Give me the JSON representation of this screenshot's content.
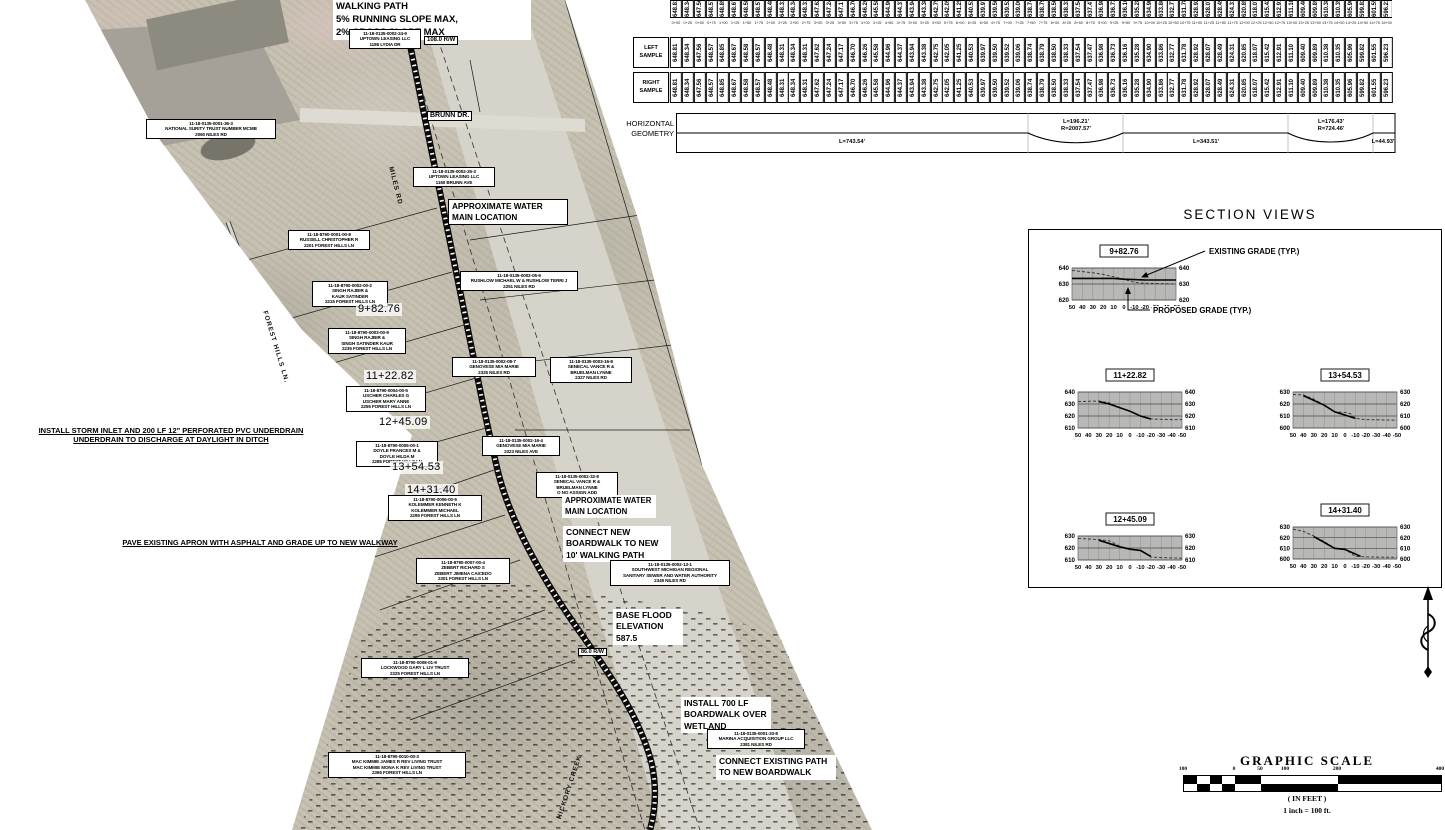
{
  "profile_table": {
    "left_label": [
      "LEFT",
      "SAMPLE"
    ],
    "right_label": [
      "RIGHT",
      "SAMPLE"
    ],
    "elevations": [
      "648.81",
      "648.34",
      "647.56",
      "648.57",
      "648.85",
      "648.67",
      "648.58",
      "648.57",
      "648.48",
      "648.31",
      "648.34",
      "648.31",
      "647.62",
      "647.24",
      "647.17",
      "646.70",
      "646.26",
      "645.58",
      "644.96",
      "644.37",
      "643.94",
      "643.38",
      "642.75",
      "642.05",
      "641.25",
      "640.53",
      "639.97",
      "639.50",
      "639.52",
      "639.06",
      "638.74",
      "638.79",
      "638.50",
      "638.33",
      "637.54",
      "637.47",
      "636.98",
      "636.73",
      "636.16",
      "635.28",
      "634.90",
      "633.86",
      "632.77",
      "631.78",
      "628.92",
      "628.07",
      "628.49",
      "624.31",
      "620.85",
      "618.07",
      "615.42",
      "612.91",
      "611.10",
      "609.40",
      "609.89",
      "610.38",
      "610.35",
      "605.96",
      "599.82",
      "601.55",
      "596.23"
    ],
    "stations": [
      "0+00",
      "0+25",
      "0+50",
      "0+75",
      "1+00",
      "1+25",
      "1+50",
      "1+75",
      "2+00",
      "2+25",
      "2+50",
      "2+75",
      "3+00",
      "3+25",
      "3+50",
      "3+75",
      "4+00",
      "4+25",
      "4+50",
      "4+75",
      "5+00",
      "5+25",
      "5+50",
      "5+75",
      "6+00",
      "6+25",
      "6+50",
      "6+75",
      "7+00",
      "7+25",
      "7+50",
      "7+75",
      "8+00",
      "8+25",
      "8+50",
      "8+75",
      "9+00",
      "9+25",
      "9+50",
      "9+75",
      "10+00",
      "10+25",
      "10+50",
      "10+75",
      "11+00",
      "11+25",
      "11+50",
      "11+75",
      "12+00",
      "12+25",
      "12+50",
      "12+75",
      "13+00",
      "13+25",
      "13+50",
      "13+75",
      "14+00",
      "14+25",
      "14+50",
      "14+75",
      "15+00"
    ]
  },
  "horizontal_geometry": {
    "label_line1": "HORIZONTAL",
    "label_line2": "GEOMETRY",
    "segments": [
      {
        "type": "tangent",
        "length": "L=743.54'"
      },
      {
        "type": "curve",
        "length": "L=196.21'",
        "radius": "R=2007.57'"
      },
      {
        "type": "tangent",
        "length": "L=343.51'"
      },
      {
        "type": "curve",
        "length": "L=176.43'",
        "radius": "R=724.46'"
      },
      {
        "type": "tangent",
        "length": "L=44.93'"
      }
    ]
  },
  "section_views": {
    "title": "SECTION VIEWS",
    "existing_grade_label": "EXISTING GRADE (TYP.)",
    "proposed_grade_label": "PROPOSED GRADE (TYP.)",
    "sections": [
      {
        "station": "9+82.76",
        "x": 1050,
        "y": 242,
        "ymax": 640,
        "ymin": 620,
        "plot_h": 32,
        "yticks": [
          "640",
          "630",
          "620"
        ],
        "xticks": [
          "50",
          "40",
          "30",
          "20",
          "10",
          "0",
          "-10",
          "-20",
          "-30",
          "-40",
          "-50"
        ],
        "existing": [
          [
            50,
            638.5
          ],
          [
            30,
            637
          ],
          [
            20,
            636
          ],
          [
            10,
            634.5
          ],
          [
            0,
            633
          ],
          [
            -10,
            631
          ],
          [
            -20,
            630.5
          ],
          [
            -50,
            630
          ]
        ],
        "proposed": [
          [
            50,
            633.5
          ],
          [
            10,
            633.5
          ],
          [
            0,
            633
          ],
          [
            -20,
            632.5
          ],
          [
            -50,
            632.5
          ]
        ]
      },
      {
        "station": "11+22.82",
        "x": 1056,
        "y": 366,
        "ymax": 640,
        "ymin": 610,
        "plot_h": 36,
        "yticks": [
          "640",
          "630",
          "620",
          "610"
        ],
        "xticks": [
          "50",
          "40",
          "30",
          "20",
          "10",
          "0",
          "-10",
          "-20",
          "-30",
          "-40",
          "-50"
        ],
        "existing": [
          [
            50,
            632
          ],
          [
            30,
            632.5
          ],
          [
            20,
            631
          ],
          [
            10,
            627
          ],
          [
            0,
            624
          ],
          [
            -10,
            620
          ],
          [
            -20,
            617.5
          ],
          [
            -40,
            617
          ],
          [
            -50,
            617
          ]
        ],
        "proposed": [
          [
            30,
            632
          ],
          [
            20,
            630
          ],
          [
            0,
            624
          ],
          [
            -10,
            620
          ],
          [
            -20,
            617.5
          ]
        ]
      },
      {
        "station": "13+54.53",
        "x": 1271,
        "y": 366,
        "ymax": 630,
        "ymin": 600,
        "plot_h": 36,
        "yticks": [
          "630",
          "620",
          "610",
          "600"
        ],
        "xticks": [
          "50",
          "40",
          "30",
          "20",
          "10",
          "0",
          "-10",
          "-20",
          "-30",
          "-40",
          "-50"
        ],
        "existing": [
          [
            50,
            628
          ],
          [
            40,
            627.5
          ],
          [
            30,
            624
          ],
          [
            20,
            619
          ],
          [
            10,
            613.5
          ],
          [
            0,
            613
          ],
          [
            -5,
            612
          ],
          [
            -10,
            608
          ],
          [
            -20,
            607
          ],
          [
            -50,
            606.5
          ]
        ],
        "proposed": [
          [
            40,
            627
          ],
          [
            20,
            619
          ],
          [
            10,
            613.5
          ],
          [
            -10,
            608
          ]
        ]
      },
      {
        "station": "12+45.09",
        "x": 1056,
        "y": 510,
        "ymax": 630,
        "ymin": 610,
        "plot_h": 24,
        "yticks": [
          "630",
          "620",
          "610"
        ],
        "xticks": [
          "50",
          "40",
          "30",
          "20",
          "10",
          "0",
          "-10",
          "-20",
          "-30",
          "-40",
          "-50"
        ],
        "existing": [
          [
            50,
            628
          ],
          [
            40,
            627.5
          ],
          [
            30,
            627
          ],
          [
            20,
            626
          ],
          [
            10,
            621.5
          ],
          [
            0,
            619
          ],
          [
            -10,
            618
          ],
          [
            -20,
            612.5
          ],
          [
            -30,
            612
          ],
          [
            -50,
            611.5
          ]
        ],
        "proposed": [
          [
            30,
            626.5
          ],
          [
            10,
            621
          ],
          [
            0,
            619
          ],
          [
            -10,
            618
          ],
          [
            -20,
            613
          ]
        ]
      },
      {
        "station": "14+31.40",
        "x": 1271,
        "y": 501,
        "ymax": 630,
        "ymin": 600,
        "plot_h": 32,
        "yticks": [
          "630",
          "620",
          "610",
          "600"
        ],
        "xticks": [
          "50",
          "40",
          "30",
          "20",
          "10",
          "0",
          "-10",
          "-20",
          "-30",
          "-40",
          "-50"
        ],
        "existing": [
          [
            50,
            628
          ],
          [
            40,
            626
          ],
          [
            30,
            621.5
          ],
          [
            20,
            616.5
          ],
          [
            10,
            610
          ],
          [
            0,
            609
          ],
          [
            -10,
            602.5
          ],
          [
            -20,
            602
          ],
          [
            -50,
            601.5
          ]
        ],
        "proposed": [
          [
            30,
            621
          ],
          [
            10,
            610
          ],
          [
            0,
            609
          ],
          [
            -15,
            602.5
          ]
        ]
      }
    ]
  },
  "graphic_scale": {
    "title": "GRAPHIC SCALE",
    "labels": [
      "100",
      "0",
      "50",
      "100",
      "200",
      "400"
    ],
    "units_note": "( IN FEET )",
    "ratio_note": "1 inch = 100 ft."
  },
  "map": {
    "labels": [
      {
        "name": "walking-path-note",
        "kind": "note",
        "x": 333,
        "y": 0,
        "w": 192,
        "fs": 9.5,
        "lines": [
          "WALKING PATH",
          "5% RUNNING SLOPE MAX,",
          "2% CROSS SLOPE MAX"
        ]
      },
      {
        "name": "parcel-uptown-lydia",
        "kind": "parcel",
        "x": 349,
        "y": 29,
        "w": 66,
        "fs": 4.6,
        "lines": [
          "11-18-0135-0002-24-9",
          "UPTOWN LEASING LLC",
          "1186 LYDIA DR"
        ]
      },
      {
        "name": "rw-108-label",
        "kind": "smallbox",
        "x": 424,
        "y": 36,
        "fs": 6,
        "lines": [
          "108.0 R/W"
        ]
      },
      {
        "name": "street-brunn-dr",
        "kind": "smallbox",
        "x": 427,
        "y": 111,
        "fs": 7,
        "lines": [
          "BRUNN DR."
        ]
      },
      {
        "name": "parcel-national-surity",
        "kind": "parcel",
        "x": 146,
        "y": 119,
        "w": 124,
        "fs": 4.6,
        "lines": [
          "11-18-0135-0001-36-3",
          "NATIONAL SURITY TRUST NUMBER MCMB",
          "2060 NILES RD"
        ]
      },
      {
        "name": "street-miles-rd",
        "kind": "street",
        "x": 394,
        "y": 166,
        "fs": 6.5,
        "rot": 76,
        "lines": [
          "MILES RD"
        ]
      },
      {
        "name": "parcel-uptown-brunn",
        "kind": "parcel",
        "x": 413,
        "y": 167,
        "w": 76,
        "fs": 4.6,
        "lines": [
          "11-18-0135-0002-25-3",
          "UPTOWN LEASING LLC",
          "1160 BRUNN AVE"
        ]
      },
      {
        "name": "water-main-note-1",
        "kind": "notebox",
        "x": 448,
        "y": 199,
        "w": 112,
        "fs": 8.2,
        "lines": [
          "APPROXIMATE WATER",
          "MAIN LOCATION"
        ]
      },
      {
        "name": "parcel-russell",
        "kind": "parcel",
        "x": 288,
        "y": 230,
        "w": 76,
        "fs": 4.6,
        "lines": [
          "11-18-8790-0001-00-8",
          "RUSSELL CHRISTOPHER R",
          "2201 FOREST HILLS LN"
        ]
      },
      {
        "name": "parcel-rushlow",
        "kind": "parcel",
        "x": 460,
        "y": 271,
        "w": 112,
        "fs": 4.6,
        "lines": [
          "11-18-0135-0002-05-9",
          "RUSHLOW MICHAEL W & RUSHLOW TERRI J",
          "2251 NILES RD"
        ]
      },
      {
        "name": "parcel-singh-kaur",
        "kind": "parcel",
        "x": 312,
        "y": 281,
        "w": 70,
        "fs": 4.6,
        "lines": [
          "11-18-8790-0002-00-2",
          "SINGH RAJBIR &",
          "KAUR SATINDER",
          "2215 FOREST HILLS LN"
        ]
      },
      {
        "name": "map-station-9-82",
        "kind": "station",
        "x": 356,
        "y": 303,
        "fs": 11,
        "lines": [
          "9+82.76"
        ]
      },
      {
        "name": "parcel-singh-satinder",
        "kind": "parcel",
        "x": 328,
        "y": 328,
        "w": 72,
        "fs": 4.6,
        "lines": [
          "11-18-8790-0003-00-9",
          "SINGH RAJBIR &",
          "SINGH SATINDER KAUR",
          "2235 FOREST HILLS LN"
        ]
      },
      {
        "name": "street-forest-hills-ln",
        "kind": "street",
        "x": 268,
        "y": 310,
        "fs": 6.5,
        "rot": 73,
        "lines": [
          "FOREST HILLS LN."
        ]
      },
      {
        "name": "parcel-genovese-2325",
        "kind": "parcel",
        "x": 452,
        "y": 357,
        "w": 78,
        "fs": 4.6,
        "lines": [
          "11-18-0135-0002-08-7",
          "GENOVESE MIA MARIE",
          "2325 NILES RD"
        ]
      },
      {
        "name": "parcel-senecal-2327",
        "kind": "parcel",
        "x": 550,
        "y": 357,
        "w": 76,
        "fs": 4.6,
        "lines": [
          "11-18-0135-0003-16-8",
          "SENECAL VANCE R &",
          "BRUELMAN LYNNE",
          "2327 NILES RD"
        ]
      },
      {
        "name": "map-station-11-22",
        "kind": "station",
        "x": 364,
        "y": 370,
        "fs": 11,
        "lines": [
          "11+22.82"
        ]
      },
      {
        "name": "parcel-uscher",
        "kind": "parcel",
        "x": 346,
        "y": 386,
        "w": 74,
        "fs": 4.6,
        "lines": [
          "11-18-8790-0004-00-5",
          "USCHER CHARLES G",
          "USCHER MARY ANNE",
          "2255 FOREST HILLS LN"
        ]
      },
      {
        "name": "map-station-12-45",
        "kind": "station",
        "x": 377,
        "y": 416,
        "fs": 11,
        "lines": [
          "12+45.09"
        ]
      },
      {
        "name": "storm-inlet-note",
        "kind": "underline",
        "x": 30,
        "y": 427,
        "w": 282,
        "fs": 7.5,
        "lines": [
          "INSTALL STORM INLET AND 200 LF 12\" PERFORATED PVC UNDERDRAIN",
          "UNDERDRAIN TO DISCHARGE AT DAYLIGHT IN DITCH"
        ]
      },
      {
        "name": "parcel-doyle",
        "kind": "parcel",
        "x": 356,
        "y": 441,
        "w": 76,
        "fs": 4.6,
        "lines": [
          "11-18-8790-0005-00-1",
          "DOYLE FRANCES M &",
          "DOYLE HILDA M",
          "2285 FOREST HILLS LN"
        ]
      },
      {
        "name": "parcel-genovese-2323",
        "kind": "parcel",
        "x": 482,
        "y": 436,
        "w": 72,
        "fs": 4.6,
        "lines": [
          "11-18-0135-0002-16-4",
          "GENOVESE MIA MARIE",
          "2323 NILES AVE"
        ]
      },
      {
        "name": "map-station-13-54",
        "kind": "station",
        "x": 390,
        "y": 461,
        "fs": 11,
        "lines": [
          "13+54.53"
        ]
      },
      {
        "name": "parcel-senecal-noadd",
        "kind": "parcel",
        "x": 536,
        "y": 472,
        "w": 76,
        "fs": 4.6,
        "lines": [
          "11-18-0135-0002-32-8",
          "SENECAL VANCE R &",
          "BRUELMAN LYNNE",
          "O NO ASSIGN ADD"
        ]
      },
      {
        "name": "map-station-14-31",
        "kind": "station",
        "x": 405,
        "y": 484,
        "fs": 11,
        "lines": [
          "14+31.40"
        ]
      },
      {
        "name": "parcel-kolemmer",
        "kind": "parcel",
        "x": 388,
        "y": 495,
        "w": 88,
        "fs": 4.6,
        "lines": [
          "11-18-8790-0006-00-5",
          "KOLEMMER KENNETH K",
          "KOLEMMER MICHAEL",
          "2295 FOREST HILLS LN"
        ]
      },
      {
        "name": "water-main-note-2",
        "kind": "note",
        "x": 562,
        "y": 495,
        "w": 88,
        "fs": 7.8,
        "lines": [
          "APPROXIMATE WATER",
          "MAIN LOCATION"
        ]
      },
      {
        "name": "pave-apron-note",
        "kind": "underline",
        "x": 100,
        "y": 539,
        "w": 320,
        "fs": 7.5,
        "lines": [
          "PAVE EXISTING APRON WITH ASPHALT AND GRADE UP TO NEW WALKWAY"
        ]
      },
      {
        "name": "connect-boardwalk-note",
        "kind": "note",
        "x": 563,
        "y": 526,
        "w": 102,
        "fs": 8.5,
        "lines": [
          "CONNECT NEW",
          "BOARDWALK TO NEW",
          "10' WALKING PATH"
        ]
      },
      {
        "name": "parcel-zebert",
        "kind": "parcel",
        "x": 416,
        "y": 558,
        "w": 88,
        "fs": 4.6,
        "lines": [
          "11-18-8790-0007-00-4",
          "ZEBERT RICHARD S",
          "ZEBERT JIMENA CAICEDO",
          "2301 FOREST HILLS LN"
        ]
      },
      {
        "name": "parcel-swmr-authority",
        "kind": "parcel",
        "x": 610,
        "y": 560,
        "w": 114,
        "fs": 4.6,
        "lines": [
          "11-18-0135-0002-13-1",
          "SOUTHWEST MICHIGAN REGIONAL",
          "SANITARY SEWER AND WATER AUTHORITY",
          "2349 NILES RD"
        ]
      },
      {
        "name": "base-flood-note",
        "kind": "note",
        "x": 613,
        "y": 609,
        "w": 64,
        "fs": 8.5,
        "lines": [
          "BASE FLOOD",
          "ELEVATION",
          "587.5"
        ]
      },
      {
        "name": "rw-86-label",
        "kind": "smallbox",
        "x": 578,
        "y": 648,
        "fs": 5.5,
        "lines": [
          "86.0 R/W"
        ]
      },
      {
        "name": "parcel-lockwood",
        "kind": "parcel",
        "x": 361,
        "y": 658,
        "w": 102,
        "fs": 4.6,
        "lines": [
          "11-18-8790-0008-01-9",
          "LOCKWOOD GARY L LIV TRUST",
          "2325 FOREST HILLS LN"
        ]
      },
      {
        "name": "install-700-note",
        "kind": "note",
        "x": 681,
        "y": 697,
        "w": 84,
        "fs": 8.5,
        "lines": [
          "INSTALL 700 LF",
          "BOARDWALK OVER",
          "WETLAND"
        ]
      },
      {
        "name": "parcel-marina",
        "kind": "parcel",
        "x": 707,
        "y": 729,
        "w": 92,
        "fs": 4.6,
        "lines": [
          "11-18-0135-0001-33-8",
          "MARINA ACQUISITION GROUP LLC",
          "2381 NILES RD"
        ]
      },
      {
        "name": "connect-existing-note",
        "kind": "note",
        "x": 716,
        "y": 755,
        "w": 114,
        "fs": 8.5,
        "lines": [
          "CONNECT EXISTING PATH",
          "TO NEW BOARDWALK"
        ]
      },
      {
        "name": "parcel-mackimmie",
        "kind": "parcel",
        "x": 328,
        "y": 752,
        "w": 132,
        "fs": 4.6,
        "lines": [
          "11-18-8790-0010-00-3",
          "MAC KIMMIE JAMES R REV LIVING TRUST",
          "MAC KIMMIE MONA K REV LIVING TRUST",
          "2365 FOREST HILLS LN"
        ]
      },
      {
        "name": "street-hickory-creek",
        "kind": "street",
        "x": 556,
        "y": 818,
        "fs": 6.5,
        "rot": -72,
        "lines": [
          "HICKORY CREEK"
        ]
      }
    ]
  }
}
